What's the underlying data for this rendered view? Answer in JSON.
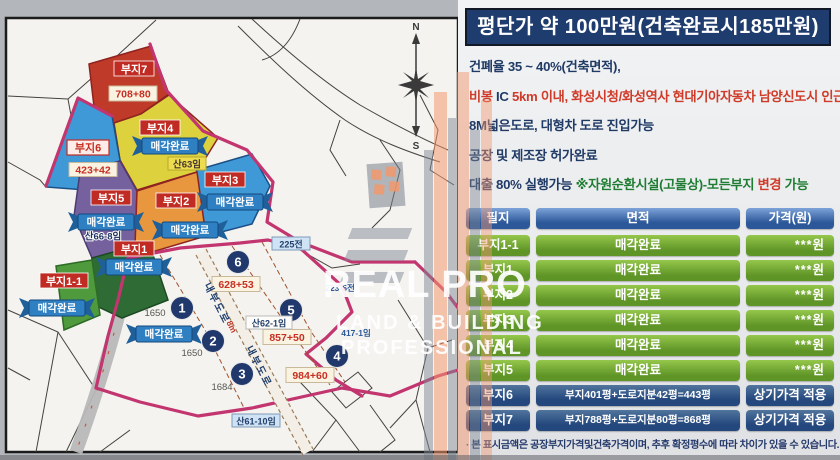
{
  "panel": {
    "title": "평단가 약 100만원(건축완료시185만원)",
    "notes": {
      "n1": "건폐율 35 ~ 40%(건축면적),",
      "n2a": "비봉 ",
      "n2b": "IC ",
      "n2c": "5km 이내, 화성시청/화성역사 현대기아자동차 남양신도시 인근",
      "n3": "8M넓은도로, 대형차 도로 진입가능",
      "n4": "공장 및 제조장 허가완료",
      "n5a": "대출 80% 실행가능 ",
      "n5b": "※자원순환시설(고물상)-모든부지 ",
      "n5c": "변경",
      "n5d": " 가능"
    },
    "table": {
      "headers": {
        "h1": "필지",
        "h2": "면적",
        "h3": "가격(원)"
      },
      "rows": [
        {
          "name": "부지1-1",
          "area": "매각완료",
          "price": "***원"
        },
        {
          "name": "부지1",
          "area": "매각완료",
          "price": "***원"
        },
        {
          "name": "부지2",
          "area": "매각완료",
          "price": "***원"
        },
        {
          "name": "부지3",
          "area": "매각완료",
          "price": "***원"
        },
        {
          "name": "부지4",
          "area": "매각완료",
          "price": "***원"
        },
        {
          "name": "부지5",
          "area": "매각완료",
          "price": "***원"
        },
        {
          "name": "부지6",
          "area": "부지401평+도로지분42평=443평",
          "price": "상기가격 적용"
        },
        {
          "name": "부지7",
          "area": "부지788평+도로지분80평=868평",
          "price": "상기가격 적용"
        }
      ],
      "footnote": "· 본 표시금액은 공장부지가격및건축가격이며, 추후 확정평수에 따라 차이가 있을 수 있습니다."
    }
  },
  "map": {
    "plot_labels": {
      "p7": "부지7",
      "p7_area": "708+80",
      "p6": "부지6",
      "p6_area": "423+42",
      "p5": "부지5",
      "p5_parcel": "산66-8임",
      "p4": "부지4",
      "p4_parcel": "산63임",
      "p3": "부지3",
      "p2": "부지2",
      "p1": "부지1",
      "p11": "부지1-1"
    },
    "sold_ribbon": "매각완료",
    "sites": {
      "s1": "1",
      "s1_note": "1650",
      "s2": "2",
      "s2_note": "1650",
      "s3": "3",
      "s3_note": "1684",
      "s4": "4",
      "s4_note": "984+60",
      "s5": "5",
      "s5_note": "857+50",
      "s5_parcel": "산62-1임",
      "s6": "6",
      "s6_note": "628+53"
    },
    "small_labels": {
      "l1": "225전",
      "l2": "223-5전",
      "l3": "417-1임",
      "l4": "산61-10임"
    },
    "roads": {
      "inner1": "내부도로",
      "inner2": "내부도로",
      "width_note": "8m"
    },
    "compass": {
      "north": "N",
      "south": "S"
    }
  },
  "watermark": {
    "line1": "REAL PRO",
    "line2": "LAND & BUILDING",
    "line3": "PROFESSIONAL"
  },
  "colors": {
    "title_bg": "#1e3c6e",
    "green_cell": "#6da22e",
    "blue_cell": "#2b5293",
    "red_label": "#c02c24",
    "ribbon": "#2e7cc0",
    "road_pink": "#c2356f"
  }
}
